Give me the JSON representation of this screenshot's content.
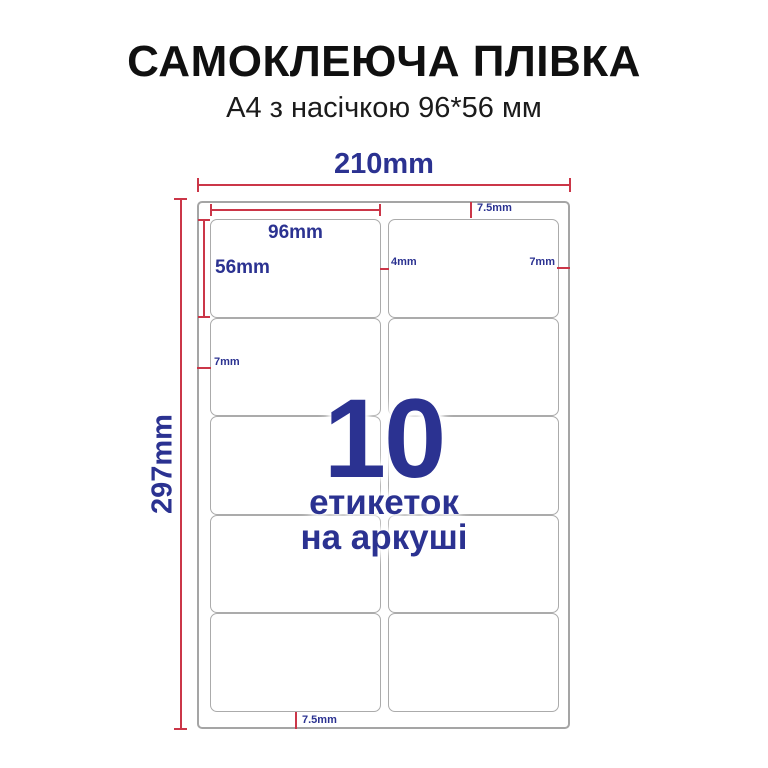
{
  "header": {
    "title": "САМОКЛЕЮЧА ПЛІВКА",
    "subtitle": "А4 з насічкою 96*56 мм"
  },
  "colors": {
    "accent_blue": "#2b3291",
    "dimension_red": "#cb3648",
    "sheet_border": "#a5a5a5",
    "label_border": "#ababab"
  },
  "sheet": {
    "rows": 5,
    "columns": 2,
    "labels_total": 10
  },
  "dims": {
    "sheet_width": "210mm",
    "sheet_height": "297mm",
    "label_width": "96mm",
    "label_height": "56mm",
    "top_margin": "7.5mm",
    "bottom_margin": "7.5mm",
    "left_margin": "7mm",
    "right_margin": "7mm",
    "column_gap": "4mm"
  },
  "center": {
    "count": "10",
    "caption_line1": "етикеток",
    "caption_line2": "на аркуші"
  }
}
